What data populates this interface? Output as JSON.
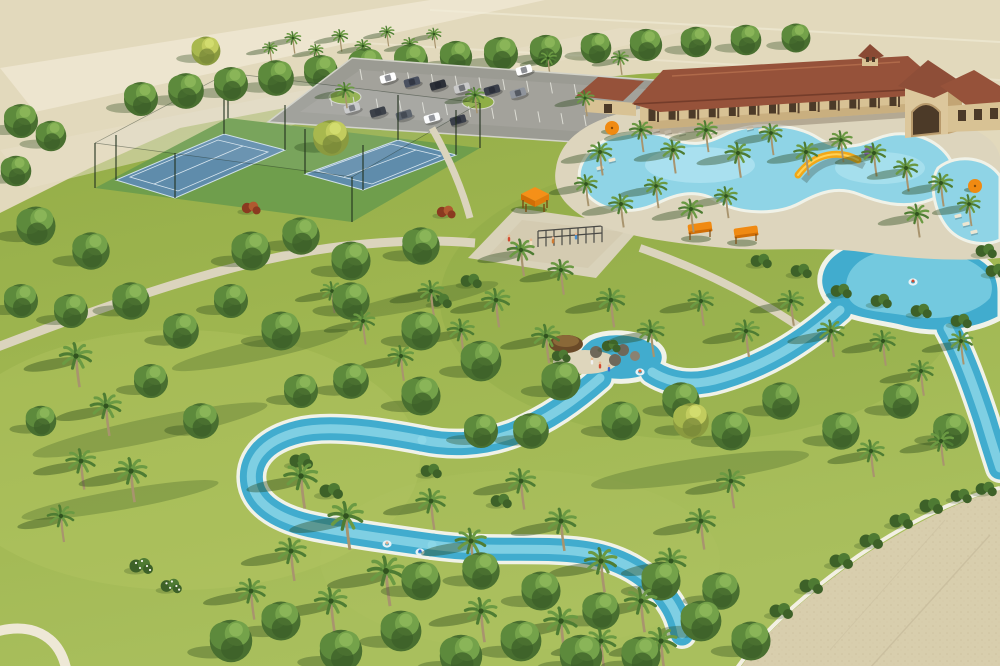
{
  "meta": {
    "title": "Aerial rendering of a resort-style community amenity center",
    "description": "3D aerial view: clubhouse with red tile roofs, freeform pool with yellow slide, winding turquoise lazy river with tube floats, two blue tennis courts, parking lot with cars, orange shade canopies, playground, palm trees and lawns, sandy undeveloped land at top and a paved plaza at bottom right."
  },
  "colors": {
    "grass_base": "#97af49",
    "grass_light": "#aec360",
    "grass_dark": "#7d9c3d",
    "land_tan": "#e2d9bc",
    "road_light": "#eee6d0",
    "path": "#dbd4bd",
    "plaza": "#d8cead",
    "plaza_speck": "#c4b894",
    "parking_asphalt": "#9b9b93",
    "parking_stripe": "#dcdcd4",
    "water": "#41acce",
    "water_light": "#8fd8e8",
    "water_deep": "#2b8fb8",
    "pool_water": "#8fd4e6",
    "pool_pale": "#b4e6f2",
    "coping": "#f0f2e8",
    "roof": "#96523a",
    "roof_dark": "#743c2a",
    "roof_ridge": "#b06a4a",
    "wall_tan": "#d8c294",
    "wall_shadow": "#c0a272",
    "opening_dark": "#4c3a28",
    "court_blue": "#5f8cab",
    "court_line": "#d8e6ef",
    "court_apron": "#6f9e4c",
    "canopy_orange": "#f08a12",
    "canopy_orange_dark": "#d06e06",
    "slide_yellow": "#f2a818",
    "umbrella_purple": "#7a5fa0",
    "tree_green": "#5d8a3c",
    "palm_green": "#4e7c33",
    "trunk": "#a8946e",
    "shadow": "rgba(40,70,25,0.40)",
    "sand_beach": "#ded6bc",
    "rock_gray": "#8a8272"
  },
  "scene": {
    "features": [
      "undeveloped-land",
      "perimeter-road",
      "parking-lot",
      "tennis-courts",
      "clubhouse",
      "entry-tower",
      "cupola",
      "resort-pool",
      "pool-deck",
      "water-slide",
      "lazy-river",
      "river-lagoon",
      "rock-grotto",
      "tiki-hut",
      "playground",
      "shade-gazebo",
      "shade-canopies",
      "paved-plaza",
      "walking-paths",
      "lawn"
    ],
    "palms": [
      [
        270,
        48,
        0.55
      ],
      [
        293,
        38,
        0.6
      ],
      [
        316,
        50,
        0.55
      ],
      [
        340,
        36,
        0.6
      ],
      [
        363,
        46,
        0.6
      ],
      [
        387,
        32,
        0.55
      ],
      [
        410,
        44,
        0.6
      ],
      [
        434,
        34,
        0.55
      ],
      [
        345,
        90,
        0.7
      ],
      [
        475,
        95,
        0.7
      ],
      [
        585,
        98,
        0.7
      ],
      [
        548,
        58,
        0.65
      ],
      [
        620,
        58,
        0.65
      ],
      [
        600,
        152,
        0.9
      ],
      [
        641,
        130,
        0.85
      ],
      [
        673,
        150,
        0.9
      ],
      [
        706,
        130,
        0.85
      ],
      [
        738,
        153,
        0.95
      ],
      [
        771,
        133,
        0.85
      ],
      [
        806,
        152,
        0.9
      ],
      [
        841,
        140,
        0.85
      ],
      [
        874,
        153,
        0.9
      ],
      [
        906,
        168,
        0.9
      ],
      [
        941,
        183,
        0.9
      ],
      [
        969,
        204,
        0.85
      ],
      [
        917,
        214,
        0.9
      ],
      [
        586,
        184,
        0.85
      ],
      [
        621,
        204,
        0.9
      ],
      [
        656,
        186,
        0.85
      ],
      [
        691,
        209,
        0.9
      ],
      [
        726,
        196,
        0.85
      ],
      [
        521,
        250,
        1
      ],
      [
        561,
        270,
        0.95
      ],
      [
        496,
        300,
        1.05
      ],
      [
        461,
        330,
        1
      ],
      [
        431,
        291,
        0.95
      ],
      [
        611,
        300,
        1.05
      ],
      [
        651,
        331,
        1
      ],
      [
        701,
        301,
        0.95
      ],
      [
        746,
        331,
        1
      ],
      [
        791,
        301,
        0.95
      ],
      [
        831,
        331,
        1
      ],
      [
        546,
        336,
        1.05
      ],
      [
        401,
        356,
        0.95
      ],
      [
        363,
        321,
        0.9
      ],
      [
        332,
        291,
        0.85
      ],
      [
        883,
        341,
        0.95
      ],
      [
        921,
        371,
        0.95
      ],
      [
        961,
        341,
        0.9
      ],
      [
        871,
        451,
        1
      ],
      [
        941,
        441,
        0.95
      ],
      [
        76,
        356,
        1.2
      ],
      [
        106,
        406,
        1.15
      ],
      [
        81,
        461,
        1.1
      ],
      [
        131,
        471,
        1.2
      ],
      [
        61,
        516,
        1
      ],
      [
        301,
        476,
        1.25
      ],
      [
        346,
        516,
        1.3
      ],
      [
        386,
        571,
        1.35
      ],
      [
        331,
        601,
        1.2
      ],
      [
        291,
        551,
        1.15
      ],
      [
        251,
        591,
        1.1
      ],
      [
        431,
        501,
        1.1
      ],
      [
        471,
        541,
        1.15
      ],
      [
        521,
        481,
        1.1
      ],
      [
        561,
        521,
        1.15
      ],
      [
        601,
        561,
        1.2
      ],
      [
        641,
        601,
        1.2
      ],
      [
        561,
        621,
        1.25
      ],
      [
        481,
        611,
        1.2
      ],
      [
        671,
        561,
        1.15
      ],
      [
        701,
        521,
        1.1
      ],
      [
        731,
        481,
        1.05
      ],
      [
        661,
        641,
        1.2
      ],
      [
        601,
        641,
        1.15
      ]
    ],
    "trees": [
      [
        141,
        99,
        1
      ],
      [
        186,
        91,
        1.05
      ],
      [
        231,
        84,
        1
      ],
      [
        276,
        78,
        1.05
      ],
      [
        321,
        72,
        1
      ],
      [
        366,
        66,
        1.05
      ],
      [
        411,
        61,
        1
      ],
      [
        456,
        57,
        0.95
      ],
      [
        501,
        54,
        1
      ],
      [
        546,
        51,
        0.95
      ],
      [
        596,
        48,
        0.9
      ],
      [
        646,
        45,
        0.95
      ],
      [
        696,
        42,
        0.9
      ],
      [
        746,
        40,
        0.9
      ],
      [
        796,
        38,
        0.85
      ],
      [
        21,
        121,
        1
      ],
      [
        51,
        136,
        0.9
      ],
      [
        16,
        171,
        0.9
      ],
      [
        36,
        226,
        1.15
      ],
      [
        91,
        251,
        1.1
      ],
      [
        21,
        301,
        1
      ],
      [
        131,
        301,
        1.1
      ],
      [
        71,
        311,
        1
      ],
      [
        181,
        331,
        1.05
      ],
      [
        231,
        301,
        1
      ],
      [
        151,
        381,
        1
      ],
      [
        201,
        421,
        1.05
      ],
      [
        41,
        421,
        0.9
      ],
      [
        251,
        251,
        1.15
      ],
      [
        301,
        236,
        1.1
      ],
      [
        351,
        261,
        1.15
      ],
      [
        421,
        246,
        1.1
      ],
      [
        281,
        331,
        1.15
      ],
      [
        351,
        301,
        1.1
      ],
      [
        421,
        331,
        1.15
      ],
      [
        481,
        361,
        1.2
      ],
      [
        421,
        396,
        1.15
      ],
      [
        351,
        381,
        1.05
      ],
      [
        301,
        391,
        1
      ],
      [
        561,
        381,
        1.15
      ],
      [
        621,
        421,
        1.15
      ],
      [
        681,
        401,
        1.1
      ],
      [
        731,
        431,
        1.15
      ],
      [
        781,
        401,
        1.1
      ],
      [
        841,
        431,
        1.1
      ],
      [
        901,
        401,
        1.05
      ],
      [
        951,
        431,
        1.05
      ],
      [
        531,
        431,
        1.05
      ],
      [
        481,
        431,
        1
      ],
      [
        231,
        641,
        1.25
      ],
      [
        281,
        621,
        1.15
      ],
      [
        341,
        651,
        1.25
      ],
      [
        401,
        631,
        1.2
      ],
      [
        461,
        656,
        1.25
      ],
      [
        521,
        641,
        1.2
      ],
      [
        581,
        656,
        1.25
      ],
      [
        641,
        656,
        1.15
      ],
      [
        701,
        621,
        1.2
      ],
      [
        421,
        581,
        1.15
      ],
      [
        481,
        571,
        1.1
      ],
      [
        541,
        591,
        1.15
      ],
      [
        601,
        611,
        1.1
      ],
      [
        661,
        581,
        1.15
      ],
      [
        721,
        591,
        1.1
      ],
      [
        751,
        641,
        1.15
      ]
    ],
    "yellow_trees": [
      [
        331,
        138,
        1.05
      ],
      [
        691,
        421,
        1.05
      ],
      [
        206,
        51,
        0.85
      ]
    ],
    "shrubs": [
      [
        301,
        461,
        1,
        "dark"
      ],
      [
        331,
        491,
        1,
        "dark"
      ],
      [
        561,
        356,
        0.8,
        "dark"
      ],
      [
        611,
        346,
        0.8,
        "dark"
      ],
      [
        761,
        261,
        0.9,
        "dark"
      ],
      [
        801,
        271,
        0.9,
        "dark"
      ],
      [
        841,
        291,
        0.9,
        "dark"
      ],
      [
        881,
        301,
        0.9,
        "dark"
      ],
      [
        921,
        311,
        0.9,
        "dark"
      ],
      [
        961,
        321,
        0.9,
        "dark"
      ],
      [
        781,
        611,
        1,
        "dark"
      ],
      [
        811,
        586,
        1,
        "dark"
      ],
      [
        841,
        561,
        1,
        "dark"
      ],
      [
        871,
        541,
        1,
        "dark"
      ],
      [
        901,
        521,
        1,
        "dark"
      ],
      [
        931,
        506,
        1,
        "dark"
      ],
      [
        961,
        496,
        0.9,
        "dark"
      ],
      [
        986,
        489,
        0.9,
        "dark"
      ],
      [
        986,
        251,
        0.9,
        "dark"
      ],
      [
        996,
        271,
        0.9,
        "dark"
      ],
      [
        471,
        281,
        0.9,
        "dark"
      ],
      [
        441,
        301,
        0.9,
        "dark"
      ],
      [
        431,
        471,
        0.9,
        "dark"
      ],
      [
        501,
        501,
        0.9,
        "dark"
      ],
      [
        141,
        566,
        1,
        "flower"
      ],
      [
        171,
        586,
        0.9,
        "flower"
      ],
      [
        251,
        208,
        0.8,
        "red"
      ],
      [
        446,
        212,
        0.8,
        "red"
      ]
    ],
    "cars": [
      [
        388,
        78,
        "#ffffff"
      ],
      [
        412,
        82,
        "#4a5160"
      ],
      [
        438,
        85,
        "#2c3038"
      ],
      [
        462,
        88,
        "#c9c9c9"
      ],
      [
        492,
        90,
        "#3a3f4a"
      ],
      [
        518,
        93,
        "#8f949c"
      ],
      [
        352,
        108,
        "#c9c9c9"
      ],
      [
        378,
        112,
        "#2c3038"
      ],
      [
        404,
        115,
        "#50565f"
      ],
      [
        432,
        118,
        "#ffffff"
      ],
      [
        458,
        120,
        "#3a3f4a"
      ],
      [
        664,
        92,
        "#4a5160"
      ],
      [
        688,
        95,
        "#ffffff"
      ],
      [
        524,
        70,
        "#ffffff"
      ]
    ],
    "chairs": [
      [
        644,
        128
      ],
      [
        656,
        130
      ],
      [
        668,
        132
      ],
      [
        682,
        133
      ],
      [
        700,
        130
      ],
      [
        714,
        131
      ],
      [
        750,
        128
      ],
      [
        762,
        130
      ],
      [
        774,
        131
      ],
      [
        958,
        216
      ],
      [
        966,
        224
      ],
      [
        974,
        232
      ],
      [
        612,
        160
      ],
      [
        600,
        168
      ]
    ],
    "floats": [
      [
        387,
        544,
        "#e0b090"
      ],
      [
        420,
        552,
        "#3a6ad0"
      ],
      [
        640,
        372,
        "#e06a40"
      ],
      [
        913,
        282,
        "#d04a30"
      ]
    ],
    "people": [
      [
        600,
        365,
        "#d04a30"
      ],
      [
        609,
        368,
        "#3a6ad0"
      ],
      [
        592,
        361,
        "#f0f0f0"
      ],
      [
        509,
        238,
        "#d04a30"
      ],
      [
        517,
        246,
        "#3a6ad0"
      ],
      [
        531,
        242,
        "#f0e0c0"
      ],
      [
        553,
        240,
        "#d07a30"
      ],
      [
        576,
        236,
        "#4a90d0"
      ]
    ],
    "umbrellas": [
      [
        612,
        128,
        "orange"
      ],
      [
        975,
        186,
        "orange"
      ],
      [
        870,
        152,
        "purple"
      ],
      [
        700,
        228,
        "canopy"
      ],
      [
        746,
        232,
        "canopy"
      ],
      [
        535,
        196,
        "gazebo"
      ]
    ]
  }
}
